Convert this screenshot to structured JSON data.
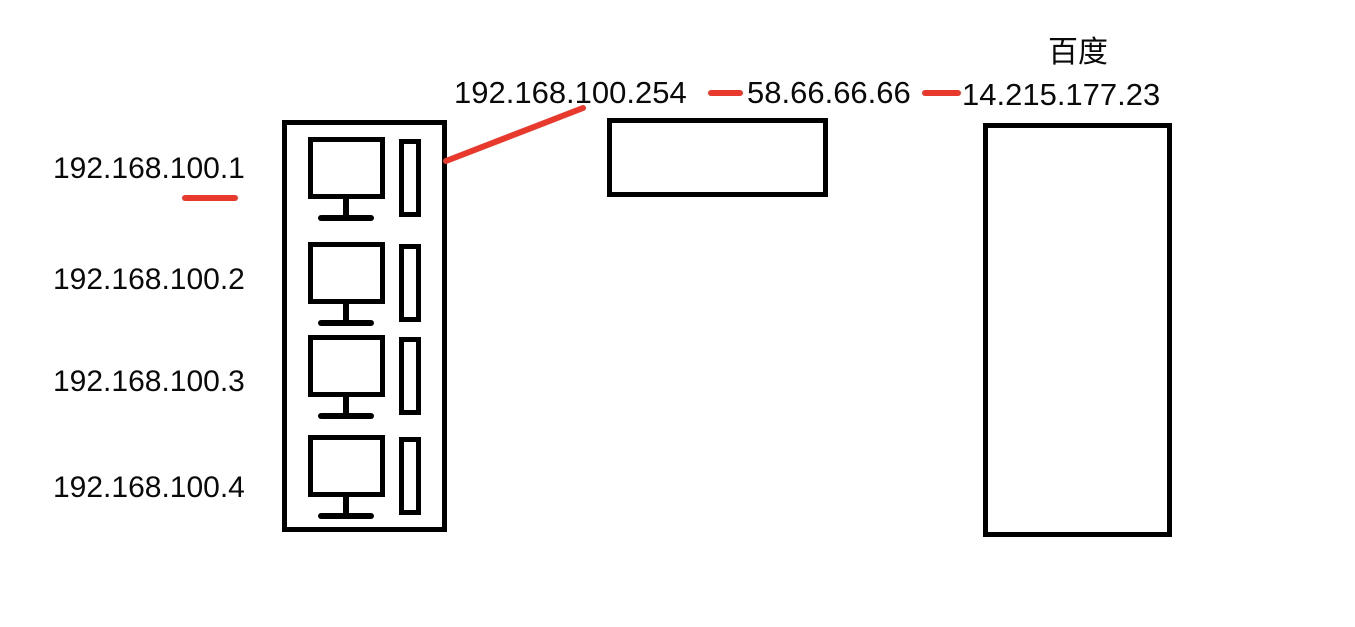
{
  "colors": {
    "annotation_red": "#e8392c",
    "ink_black": "#000000"
  },
  "lan_hosts": [
    {
      "ip": "192.168.100.1"
    },
    {
      "ip": "192.168.100.2"
    },
    {
      "ip": "192.168.100.3"
    },
    {
      "ip": "192.168.100.4"
    }
  ],
  "gateway": {
    "lan_ip": "192.168.100.254",
    "wan_ip": "58.66.66.66"
  },
  "remote_server": {
    "name": "百度",
    "ip": "14.215.177.23"
  }
}
